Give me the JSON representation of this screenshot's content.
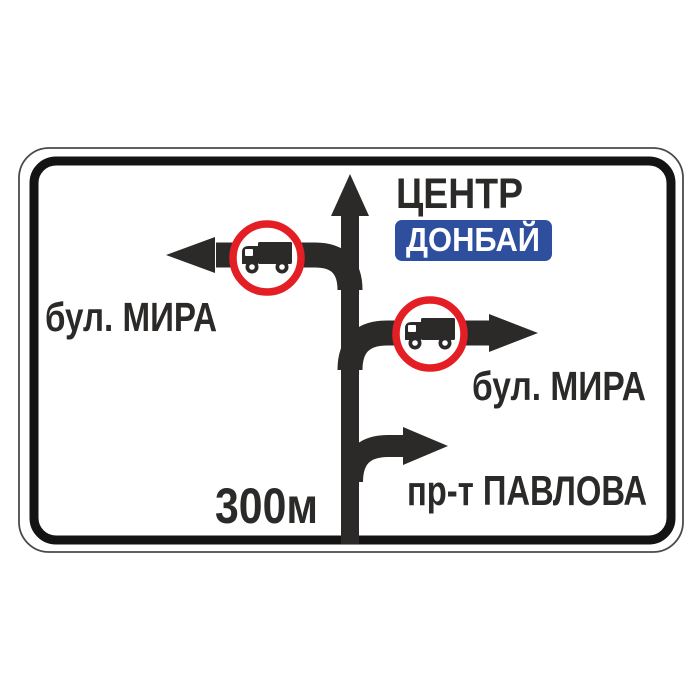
{
  "sign": {
    "kind": "advance-direction-road-sign",
    "directions": {
      "straight": {
        "label": "ЦЕНТР",
        "city": "ДОНБАЙ"
      },
      "left": {
        "label": "бул. МИРА",
        "restriction": "no-trucks"
      },
      "right": {
        "label": "бул. МИРА",
        "restriction": "no-trucks"
      },
      "slight_right": {
        "label": "пр-т ПАВЛОВА"
      }
    },
    "distance_label": "300м"
  },
  "colors": {
    "ink": "#2b2a29",
    "border": "#141414",
    "outline": "#4a4a4a",
    "red": "#e31e24",
    "blue": "#2d4f9e",
    "white": "#ffffff"
  }
}
